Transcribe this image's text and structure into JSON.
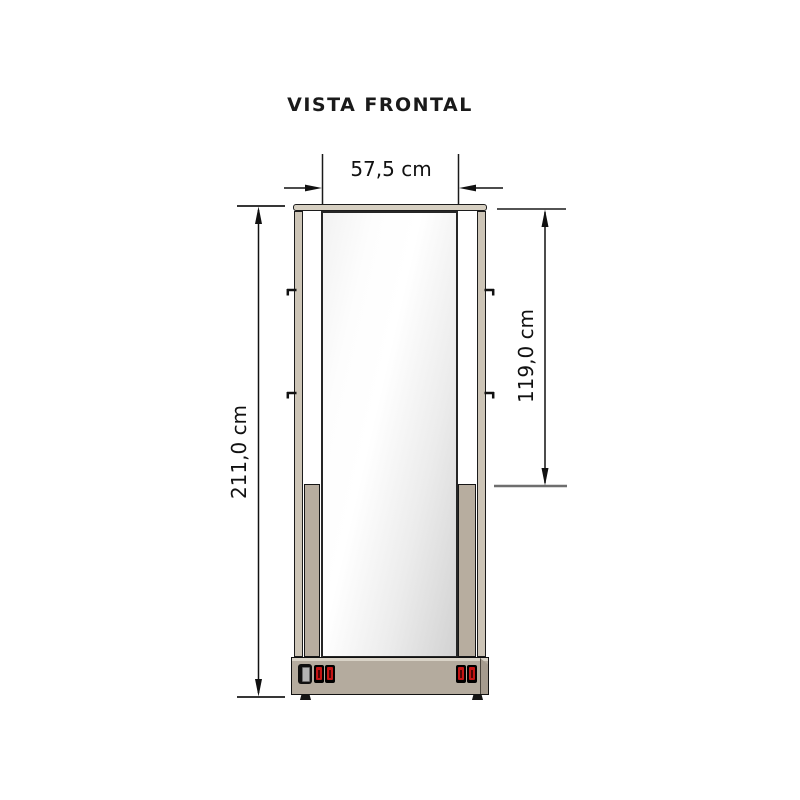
{
  "title": "VISTA FRONTAL",
  "dimensions": {
    "total_height": "211,0 cm",
    "glass_width": "57,5 cm",
    "glass_height": "119,0 cm"
  },
  "cabinet": {
    "switch_panel": {
      "left_switches": [
        "power-rocker-switch",
        "red-rocker-switch",
        "red-rocker-switch"
      ],
      "right_switches": [
        "red-rocker-switch",
        "red-rocker-switch"
      ]
    }
  },
  "colors": {
    "frame_beige": "#cdc5b7",
    "side_panel_taupe": "#b7ad9f",
    "base_taupe": "#b4ab9e",
    "outline_black": "#1c1c1c",
    "switch_red": "#c41414",
    "extension_line_gray": "#6e6e6e",
    "mirror_gray": "#d2d2d2",
    "background": "#ffffff"
  }
}
